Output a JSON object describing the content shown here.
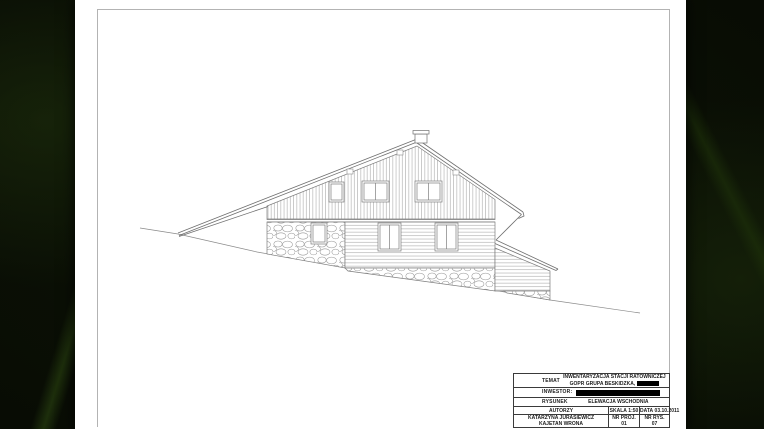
{
  "sheet": {
    "drawing_type": "building elevation line drawing"
  },
  "title_block": {
    "temat_label": "TEMAT",
    "temat_value_line1": "INWENTARYZACJA STACJI RATOWNICZEJ",
    "temat_value_line2": "GOPR GRUPA BESKIDZKA,",
    "inwestor_label": "INWESTOR:",
    "rysunek_label": "RYSUNEK",
    "rysunek_value": "ELEWACJA WSCHODNIA",
    "autorzy_label": "AUTORZY",
    "autor_1": "KATARZYNA JURASIEWICZ",
    "autor_2": "KAJETAN WRONA",
    "skala_label": "SKALA",
    "skala_value": "1:50",
    "data_label": "DATA",
    "data_value": "03.10.2011",
    "nr_proj_label": "NR PROJ.",
    "nr_proj_value": "01",
    "nr_rys_label": "NR RYS.",
    "nr_rys_value": "07"
  }
}
